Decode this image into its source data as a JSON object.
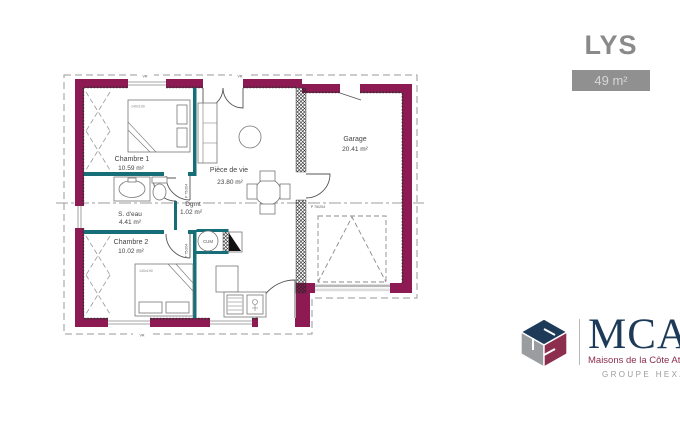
{
  "colors": {
    "exterior-wall": "#8d1a52",
    "interior-wall": "#156e78",
    "brand-navy": "#1d3b58",
    "brand-maroon": "#8c2f4f",
    "badge-gray": "#909090",
    "text-gray": "#8a8a8a"
  },
  "header": {
    "title": "LYS",
    "area_badge": "49 m²"
  },
  "plan": {
    "rooms": [
      {
        "name": "Chambre 1",
        "area": "10.59 m²"
      },
      {
        "name": "S. d'eau",
        "area": "4.41 m²"
      },
      {
        "name": "Dgmt",
        "area": "1.02 m²"
      },
      {
        "name": "Chambre 2",
        "area": "10.02 m²"
      },
      {
        "name": "Pièce de vie",
        "area": "23.80 m²"
      },
      {
        "name": "Garage",
        "area": "20.41 m²"
      }
    ],
    "labels": {
      "bed_size": "140x190",
      "water_heater": "CUM",
      "door": "P 75/204",
      "shutter": "VR"
    }
  },
  "logo": {
    "brand": "MCA",
    "tagline": "Maisons de la Côte Atlantique",
    "group": "GROUPE HEXA"
  }
}
